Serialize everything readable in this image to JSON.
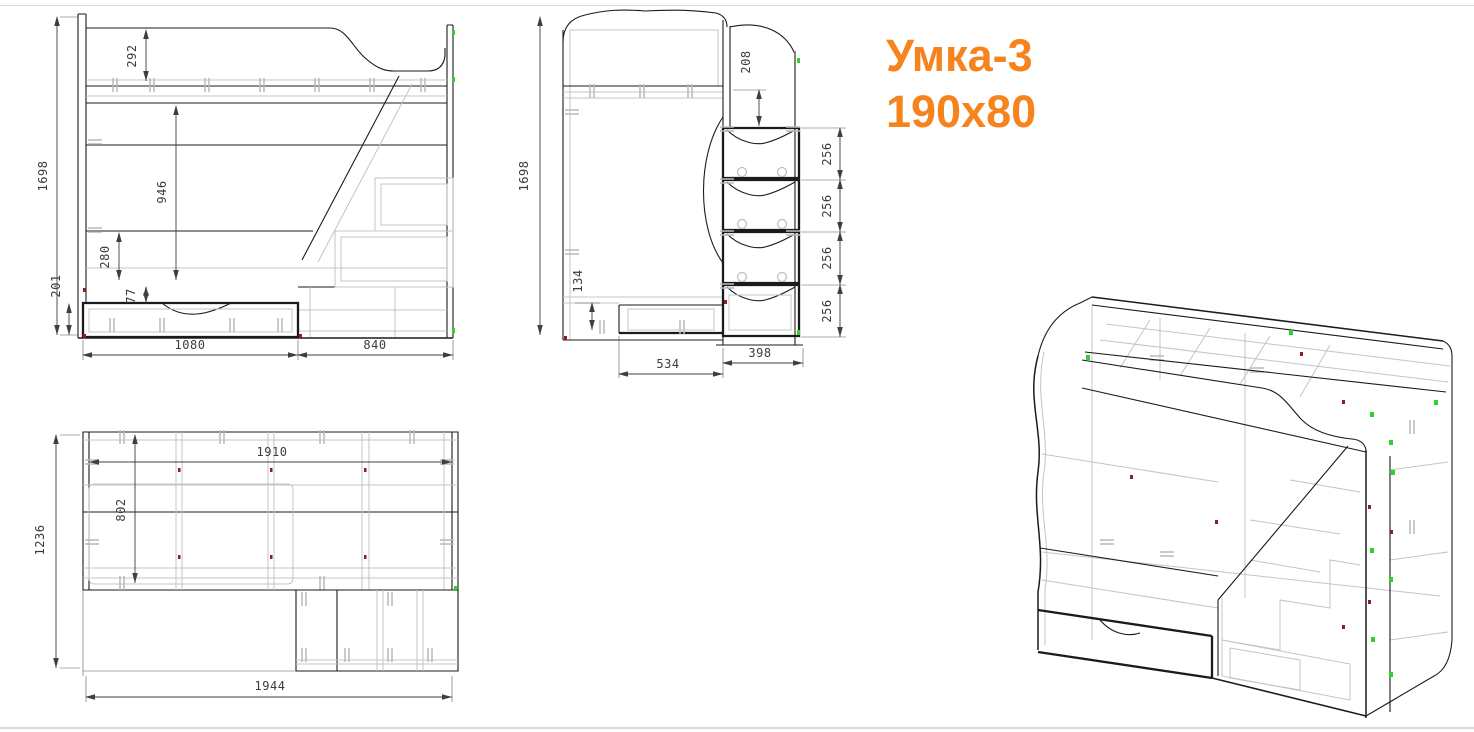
{
  "title": {
    "line1": "Умка-3",
    "line2": "190x80"
  },
  "colors": {
    "accent_orange": "#F6831D",
    "object_line": "#1b1b1b",
    "hidden_line": "#c4c4c4",
    "dimension_text": "#3c3c3c",
    "marker_green": "#2fd02f",
    "marker_red": "#8b2020",
    "sheet_frame": "#d9d9d9",
    "background": "#ffffff"
  },
  "views": {
    "front": {
      "name": "front-elevation",
      "dims": {
        "total_height": "1698",
        "rail_height": "292",
        "under_bed_clearance": "946",
        "shelf_gap": "280",
        "base_height": "201",
        "drawer_gap": "77",
        "bed_section_width": "1080",
        "stairs_section_width": "840"
      }
    },
    "side": {
      "name": "side-elevation",
      "dims": {
        "total_height": "1698",
        "rail_to_drawers": "208",
        "drawer_1": "256",
        "drawer_2": "256",
        "drawer_3": "256",
        "drawer_4": "256",
        "kick_drawer_height": "134",
        "body_depth": "534",
        "stairs_depth": "398"
      }
    },
    "plan": {
      "name": "top-plan",
      "dims": {
        "total_depth": "1236",
        "inner_length": "1910",
        "inner_depth": "802",
        "total_length": "1944"
      }
    },
    "iso": {
      "name": "isometric-wireframe"
    }
  }
}
